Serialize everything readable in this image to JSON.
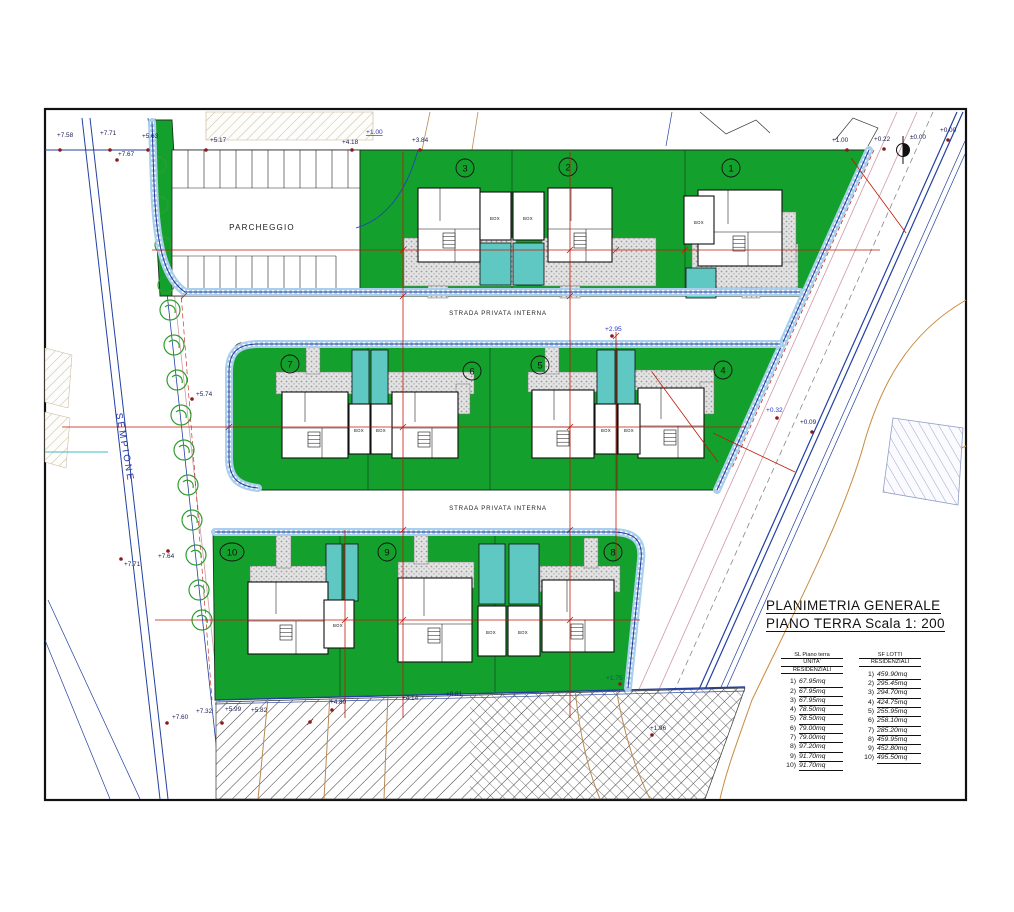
{
  "title": {
    "line1": "PLANIMETRIA GENERALE",
    "line2": "PIANO TERRA  Scala 1: 200"
  },
  "labels": {
    "parcheggio": "PARCHEGGIO",
    "street_name": "SEMPIONE",
    "private_road": "STRADA PRIVATA INTERNA",
    "box": "BOX"
  },
  "building_numbers": [
    "1",
    "2",
    "3",
    "4",
    "5",
    "6",
    "7",
    "8",
    "9",
    "10"
  ],
  "elevation_markers": [
    "+7.58",
    "+7.71",
    "+5.63",
    "+7.67",
    "+5.17",
    "+4.18",
    "+3.84",
    "+1.00",
    "+1.00",
    "+0.22",
    "±0.00",
    "+0.00",
    "+5.74",
    "+2.95",
    "+0.32",
    "+0.09",
    "+7.71",
    "+7.64",
    "+7.60",
    "+7.32",
    "+5.99",
    "+5.82",
    "+4.80",
    "+4.14",
    "+0.81",
    "+1.75",
    "+1.96"
  ],
  "tables": {
    "sl_units": {
      "header": [
        "SL Piano terra",
        "UNITA'",
        "RESIDENZIALI"
      ],
      "rows": [
        {
          "n": "1)",
          "v": "67.95mq"
        },
        {
          "n": "2)",
          "v": "67.95mq"
        },
        {
          "n": "3)",
          "v": "67.95mq"
        },
        {
          "n": "4)",
          "v": "78.50mq"
        },
        {
          "n": "5)",
          "v": "78.50mq"
        },
        {
          "n": "6)",
          "v": "79.00mq"
        },
        {
          "n": "7)",
          "v": "79.00mq"
        },
        {
          "n": "8)",
          "v": "97.20mq"
        },
        {
          "n": "9)",
          "v": "91.70mq"
        },
        {
          "n": "10)",
          "v": "91.70mq"
        }
      ]
    },
    "sf_lots": {
      "header": [
        "SF LOTTI",
        "RESIDENZIALI"
      ],
      "rows": [
        {
          "n": "1)",
          "v": "459.90mq"
        },
        {
          "n": "2)",
          "v": "295.45mq"
        },
        {
          "n": "3)",
          "v": "294.70mq"
        },
        {
          "n": "4)",
          "v": "424.75mq"
        },
        {
          "n": "5)",
          "v": "255.95mq"
        },
        {
          "n": "6)",
          "v": "258.10mq"
        },
        {
          "n": "7)",
          "v": "285.20mq"
        },
        {
          "n": "8)",
          "v": "459.95mq"
        },
        {
          "n": "9)",
          "v": "452.80mq"
        },
        {
          "n": "10)",
          "v": "495.50mq"
        }
      ]
    }
  },
  "colors": {
    "lawn": "#14a02c",
    "driveway": "#5fc8c3",
    "paving_band": "#a9cfec",
    "band_outline": "#24379b",
    "dimension_red": "#c21807",
    "contour_orange": "#c98a3e",
    "street_text_blue": "#2233aa"
  }
}
